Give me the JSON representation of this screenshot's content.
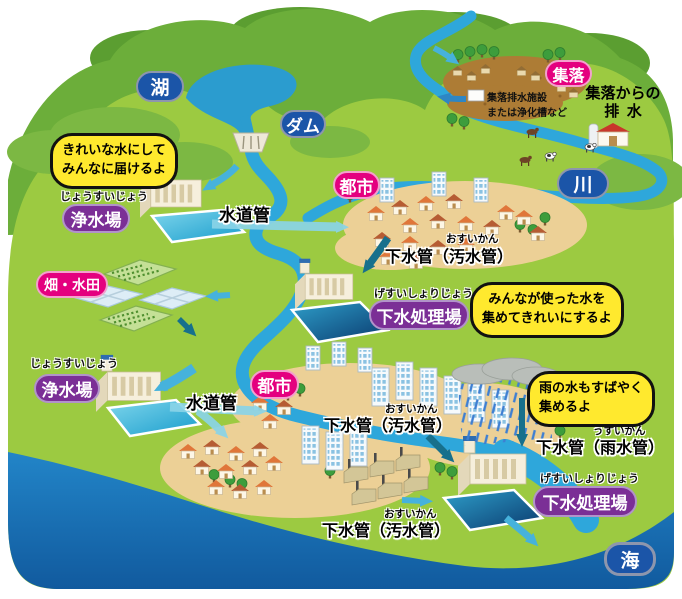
{
  "badges": {
    "lake": "湖",
    "dam": "ダム",
    "river": "川",
    "sea": "海",
    "settlement": "集落",
    "city_upper": "都市",
    "city_lower": "都市",
    "fields": "畑・水田",
    "purification_upper": {
      "furigana": "じょうすいじょう",
      "label": "浄水場"
    },
    "purification_lower": {
      "furigana": "じょうすいじょう",
      "label": "浄水場"
    },
    "sewage_mid": {
      "furigana": "げすいしょりじょう",
      "label": "下水処理場"
    },
    "sewage_lower": {
      "furigana": "げすいしょりじょう",
      "label": "下水処理場"
    }
  },
  "speech_bubbles": {
    "purification": {
      "line1": "きれいな水にして",
      "line2": "みんなに届けるよ"
    },
    "sewage": {
      "line1": "みんなが使った水を",
      "line2": "集めてきれいにするよ"
    },
    "rain": {
      "line1": "雨の水もすばやく",
      "line2": "集めるよ"
    }
  },
  "pipe_labels": {
    "water_pipe_upper": "水道管",
    "water_pipe_lower": "水道管",
    "sewer_city_upper": {
      "furigana": "おすいかん",
      "label": "下水管（汚水管）"
    },
    "sewer_city_lower": {
      "furigana": "おすいかん",
      "label": "下水管（汚水管）"
    },
    "sewer_factory": {
      "furigana": "おすいかん",
      "label": "下水管（汚水管）"
    },
    "storm_pipe": {
      "furigana": "うすいかん",
      "label": "下水管（雨水管）"
    }
  },
  "annotations": {
    "settlement_drainage": {
      "line1": "集落からの",
      "line2": "排水"
    },
    "settlement_facility": {
      "line1": "集落排水施設",
      "line2": "または浄化槽など"
    }
  },
  "colors": {
    "land_green": "#9cca41",
    "mountain_green": "#6cae3a",
    "river_blue": "#2ea7db",
    "sea_blue": "#1a6fb5",
    "badge_blue": "#1b55a8",
    "badge_pink": "#e4007f",
    "badge_purple": "#7b2f96",
    "bubble_yellow": "#ffe92e",
    "ground_tan": "#ecd096",
    "settlement_brown": "#ad7c35"
  }
}
